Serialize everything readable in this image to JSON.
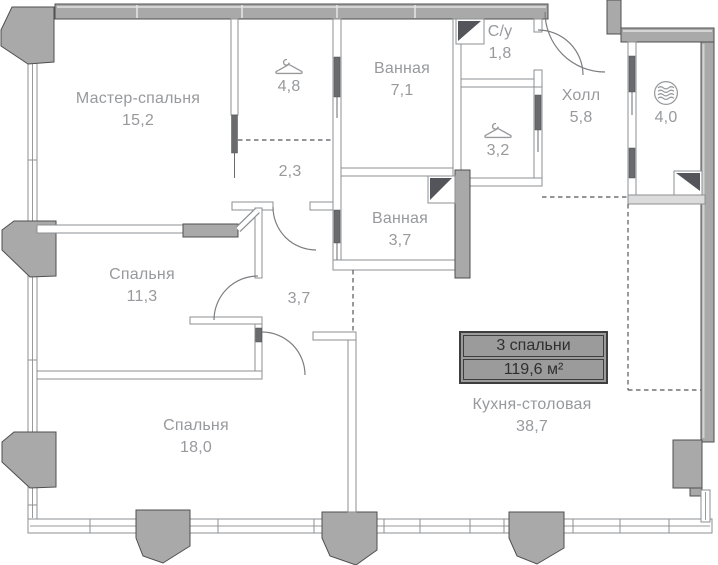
{
  "badge": {
    "rooms_count": "3 спальни",
    "total_area": "119,6 м²"
  },
  "rooms": {
    "master_bedroom": {
      "name": "Мастер-спальня",
      "area": "15,2"
    },
    "wardrobe_master": {
      "area": "4,8",
      "icon": "hanger-icon"
    },
    "bathroom_main": {
      "name": "Ванная",
      "area": "7,1"
    },
    "wc": {
      "name": "С/у",
      "area": "1,8"
    },
    "hall": {
      "name": "Холл",
      "area": "5,8"
    },
    "utility": {
      "area": "4,0",
      "icon": "waves-icon"
    },
    "corridor_upper": {
      "area": "2,3"
    },
    "wardrobe_hall": {
      "area": "3,2",
      "icon": "hanger-icon"
    },
    "bathroom_second": {
      "name": "Ванная",
      "area": "3,7"
    },
    "bedroom_second": {
      "name": "Спальня",
      "area": "11,3"
    },
    "corridor_lower": {
      "area": "3,7"
    },
    "bedroom_third": {
      "name": "Спальня",
      "area": "18,0"
    },
    "kitchen_dining": {
      "name": "Кухня-столовая",
      "area": "38,7"
    }
  },
  "colors": {
    "wall_fill": "#a9a9a9",
    "wall_outline": "#4f4f4f",
    "label_text": "#97999c",
    "badge_background": "#9b9b9b",
    "badge_border": "#3e3e3e",
    "badge_text": "#2f2f2f"
  }
}
